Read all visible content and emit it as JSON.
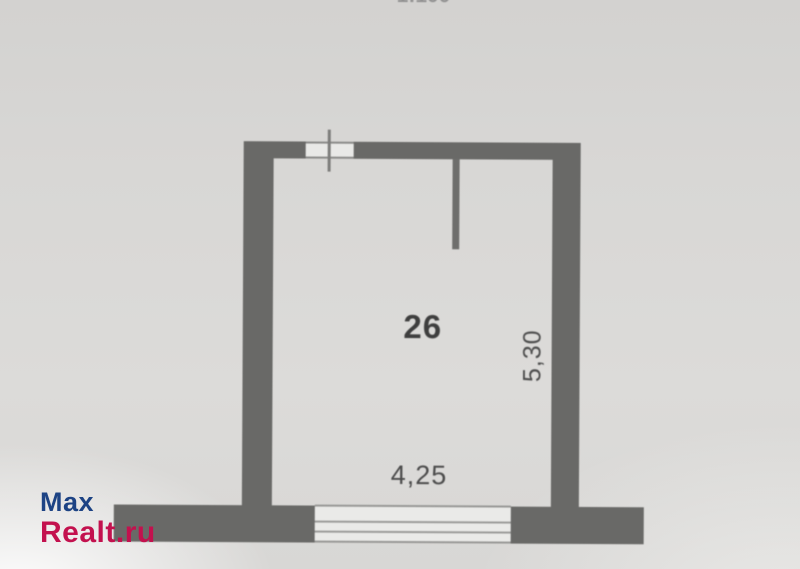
{
  "photo": {
    "paper_color": "#d8d7d5",
    "wall_color": "#696967"
  },
  "scale_label": {
    "text": "1:100"
  },
  "floor_plan": {
    "room_number": "26",
    "width_dimension": "4,25",
    "height_dimension": "5,30"
  },
  "watermark": {
    "line1": "Max",
    "line2": "Realt.ru",
    "line1_color": "#1d4384",
    "line2_color": "#c3114e"
  }
}
